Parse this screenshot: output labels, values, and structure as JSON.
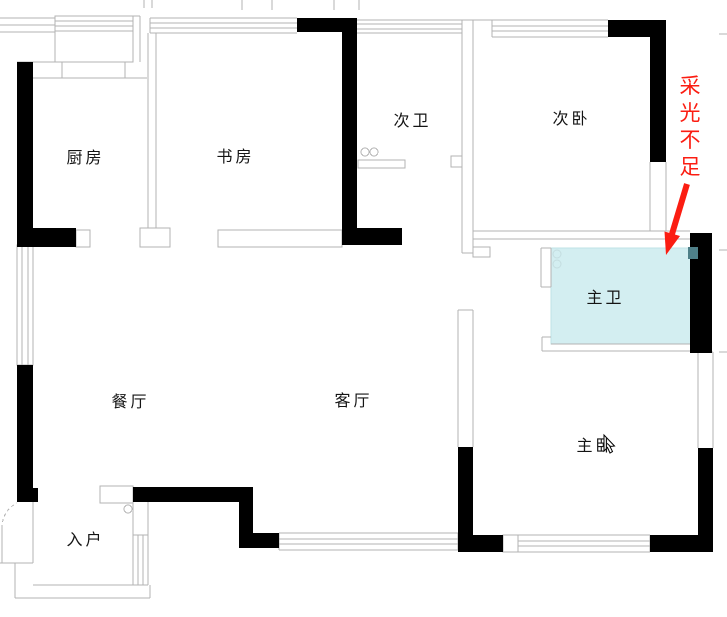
{
  "title": "户型平面图",
  "colors": {
    "wall_black": "#000000",
    "outline_gray": "#b3b3b3",
    "highlight_fill": "#d3eef1",
    "highlight_border": "#bfe3e6",
    "annotation_red": "#fb1d12",
    "fixture_teal": "#4f8089"
  },
  "rooms": [
    {
      "id": "kitchen",
      "label": "厨房"
    },
    {
      "id": "study",
      "label": "书房"
    },
    {
      "id": "second-bath",
      "label": "次卫"
    },
    {
      "id": "second-bedroom",
      "label": "次卧"
    },
    {
      "id": "master-bath",
      "label": "主卫",
      "highlighted": true
    },
    {
      "id": "dining",
      "label": "餐厅"
    },
    {
      "id": "living",
      "label": "客厅"
    },
    {
      "id": "master-bedroom",
      "label": "主卧"
    },
    {
      "id": "entry",
      "label": "入户"
    }
  ],
  "annotation": {
    "text": "采光不足",
    "target_room": "主卫"
  },
  "fixtures": [
    {
      "id": "double-sink",
      "room": "次卫"
    },
    {
      "id": "entry-door-arc",
      "room": "入户"
    },
    {
      "id": "entry-fixture",
      "room": "入户"
    },
    {
      "id": "bath-fixture",
      "room": "主卫"
    },
    {
      "id": "mouse-cursor",
      "room": "主卧"
    }
  ]
}
